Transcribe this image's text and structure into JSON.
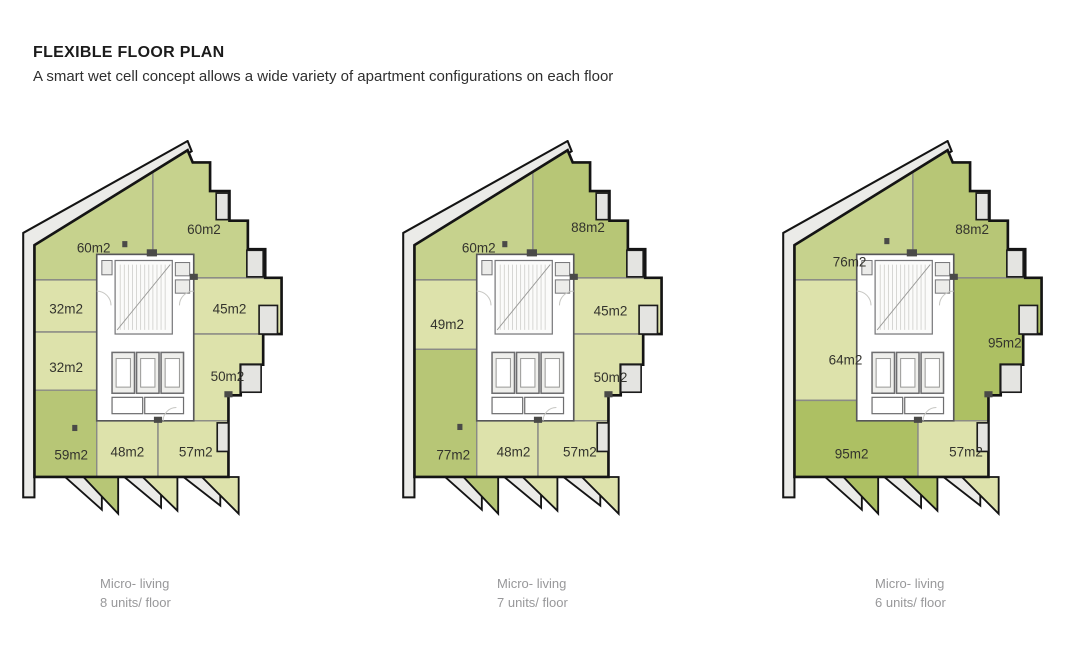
{
  "header": {
    "title": "FLEXIBLE FLOOR PLAN",
    "subtitle": "A smart wet cell concept allows a wide variety of apartment configurations on each floor"
  },
  "colors": {
    "floor": "#ffffff",
    "band": "#ebebe8",
    "balcony": "#e4e4e1",
    "unit_light": "#dde2ab",
    "unit_medium": "#c6d28d",
    "unit_dark": "#b7c676",
    "unit_darkest": "#adc063"
  },
  "plans": [
    {
      "name": "8-unit floor plan",
      "caption": {
        "line1": "Micro- living",
        "line2": "8 units/ floor"
      },
      "units": [
        {
          "label": "60m2",
          "color": "#c6d28d"
        },
        {
          "label": "60m2",
          "color": "#c6d28d"
        },
        {
          "label": "32m2",
          "color": "#dde2ab"
        },
        {
          "label": "45m2",
          "color": "#dde2ab"
        },
        {
          "label": "32m2",
          "color": "#dde2ab"
        },
        {
          "label": "50m2",
          "color": "#dde2ab"
        },
        {
          "label": "59m2",
          "color": "#b7c676"
        },
        {
          "label": "48m2",
          "color": "#dde2ab"
        },
        {
          "label": "57m2",
          "color": "#dde2ab"
        }
      ],
      "teeth": [
        "#b7c676",
        "#dde2ab",
        "#dde2ab"
      ]
    },
    {
      "name": "7-unit floor plan",
      "caption": {
        "line1": "Micro- living",
        "line2": "7 units/ floor"
      },
      "units": [
        {
          "label": "60m2",
          "color": "#c6d28d"
        },
        {
          "label": "88m2",
          "color": "#b7c676"
        },
        {
          "label": "49m2",
          "color": "#dde2ab"
        },
        {
          "label": "45m2",
          "color": "#dde2ab"
        },
        {
          "label": "50m2",
          "color": "#dde2ab"
        },
        {
          "label": "77m2",
          "color": "#b7c676"
        },
        {
          "label": "48m2",
          "color": "#dde2ab"
        },
        {
          "label": "57m2",
          "color": "#dde2ab"
        }
      ],
      "teeth": [
        "#b7c676",
        "#dde2ab",
        "#dde2ab"
      ]
    },
    {
      "name": "6-unit floor plan",
      "caption": {
        "line1": "Micro- living",
        "line2": "6 units/ floor"
      },
      "units": [
        {
          "label": "76m2",
          "color": "#c6d28d"
        },
        {
          "label": "88m2",
          "color": "#b7c676"
        },
        {
          "label": "64m2",
          "color": "#dde2ab"
        },
        {
          "label": "95m2",
          "color": "#adc063"
        },
        {
          "label": "95m2",
          "color": "#adc063"
        },
        {
          "label": "57m2",
          "color": "#dde2ab"
        }
      ],
      "teeth": [
        "#adc063",
        "#adc063",
        "#dde2ab"
      ]
    }
  ]
}
